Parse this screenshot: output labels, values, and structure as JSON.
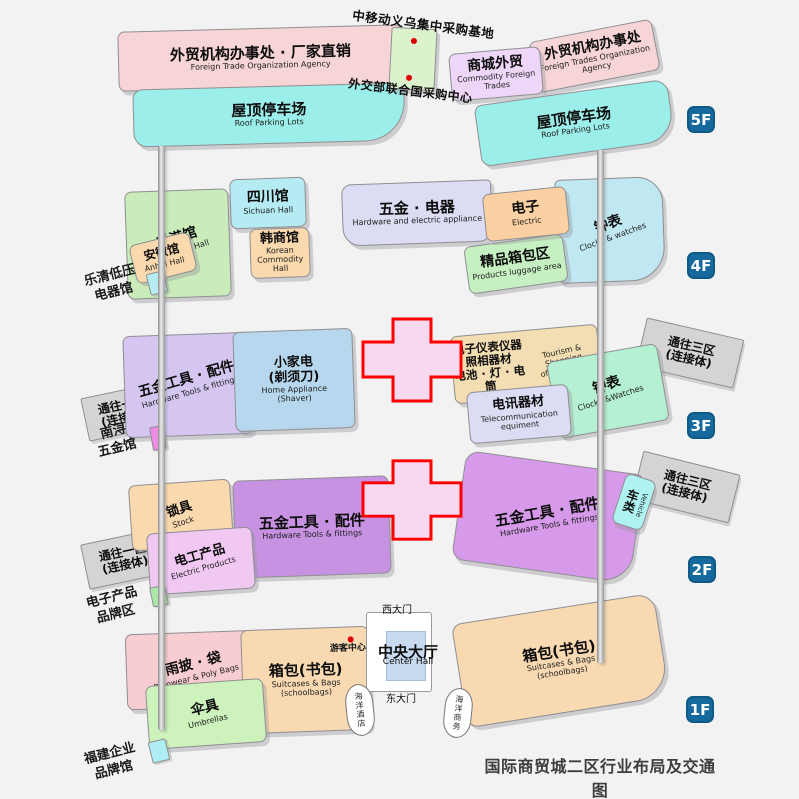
{
  "colors": {
    "badge_blue": "#16699c",
    "cross_border": "#ff0000",
    "cross_fill": "#f8d8ee",
    "connector_gray": "#d4d4d6",
    "marker_red": "#dd0000"
  },
  "title": {
    "cn": "国际商贸城二区行业布局及交通图",
    "en": "The Major Industry layout and transport map of International Trade Mart District Two"
  },
  "f5": {
    "badge": "5F",
    "ftoa_left_cn": "外贸机构办事处 · 厂家直销",
    "ftoa_left_en": "Foreign Trade Organization Agency",
    "roof_left_cn": "屋顶停车场",
    "roof_left_en": "Roof Parking Lots",
    "cmcc_base": "中移动义乌集中采购基地",
    "un_center": "外交部联合国采购中心",
    "mall_cn": "商城外贸",
    "mall_en": "Commodity Foreign Trades",
    "ftoa_right_cn": "外贸机构办事处",
    "ftoa_right_en": "Foreign Trades Organization Agency",
    "roof_right_cn": "屋顶停车场",
    "roof_right_en": "Roof Parking Lots"
  },
  "f4": {
    "badge": "4F",
    "hongkong_cn": "香港馆",
    "hongkong_en": "HongKong Hall",
    "sichuan_cn": "四川馆",
    "sichuan_en": "Sichuan Hall",
    "anhui_cn": "安徽馆",
    "anhui_en": "Anhui Hall",
    "korean_cn": "韩商馆",
    "korean_en": "Korean\nCommodity Hall",
    "hardware_cn": "五金 · 电器",
    "hardware_en": "Hardware and electric appliance",
    "electric_cn": "电子",
    "electric_en": "Electric",
    "clocks_cn": "钟表",
    "clocks_en": "Clocks & watches",
    "luggage_cn": "精品箱包区",
    "luggage_en": "Products luggage area",
    "side_label": "乐清低压\n电器馆"
  },
  "f3": {
    "badge": "3F",
    "ramp_left": "通往一区\n(连接体)",
    "hardware_tools_cn": "五金工具 · 配件",
    "hardware_tools_en": "Hardware Tools & fittings",
    "home_appliance_cn": "小家电\n(剃须刀)",
    "home_appliance_en": "Home Appliance\n(Shaver)",
    "instruments_cn": "电子仪表仪器\n照相器材\n电池 · 灯 · 电筒",
    "instruments_en": "Tourism & Shopping\nof Enterprise",
    "telecom_cn": "电讯器材",
    "telecom_en": "Telecommunication\nequiment",
    "clocks_cn": "钟表",
    "clocks_en": "Clocks &Watches",
    "ramp_right": "通往三区\n(连接体)",
    "side_label": "南浔\n五金馆"
  },
  "f2": {
    "badge": "2F",
    "ramp_left": "通往一区\n(连接体)",
    "locks_cn": "锁具",
    "locks_en": "Stock",
    "electric_products_cn": "电工产品",
    "electric_products_en": "Electric Products",
    "hardware_left_cn": "五金工具 · 配件",
    "hardware_left_en": "Hardware Tools & fittings",
    "hardware_right_cn": "五金工具 · 配件",
    "hardware_right_en": "Hardware Tools & fittings",
    "vehicle_cn": "车类",
    "vehicle_en": "Vehicle",
    "ramp_right": "通往三区\n(连接体)",
    "side_label": "电子产品\n品牌区"
  },
  "f1": {
    "badge": "1F",
    "rainwear_cn": "雨披 · 袋",
    "rainwear_en": "Rainwear & Poly Bags",
    "umbrella_cn": "伞具",
    "umbrella_en": "Umbrellas",
    "bags_left_cn": "箱包(书包)",
    "bags_left_en": "Suitcases & Bags\n(schoolbags)",
    "tourist_center": "游客中心",
    "west_gate": "西大门",
    "center_hall_cn": "中央大厅",
    "center_hall_en": "Center Hall",
    "east_gate": "东大门",
    "hotel_bubble": "海洋酒店",
    "business_bubble": "海洋商务",
    "bags_right_cn": "箱包(书包)",
    "bags_right_en": "Suitcases & Bags\n(schoolbags)",
    "side_label": "福建企业\n品牌馆"
  }
}
